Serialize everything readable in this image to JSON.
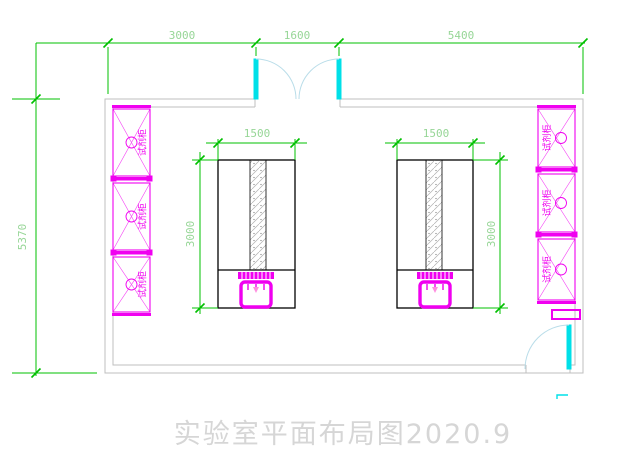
{
  "title": "实验室平面布局图2020.9",
  "colors": {
    "dimension_line": "#00c000",
    "dimension_text": "#97d697",
    "wall": "#bfbfbf",
    "cabinet": "#f000f0",
    "door": "#00e0e8",
    "door_arc": "#b9dde9",
    "bench_line": "#000000",
    "sink_accent": "#ff8fe0",
    "title_text": "#d6d6d6"
  },
  "dims": {
    "top": [
      "3000",
      "1600",
      "5400"
    ],
    "left_overall": "5370",
    "bench_left_width": "1500",
    "bench_left_depth": "3000",
    "bench_right_width": "1500",
    "bench_right_depth": "3000"
  },
  "cabinets": {
    "left": [
      {
        "label": "试剂柜"
      },
      {
        "label": "试剂柜"
      },
      {
        "label": "试剂柜"
      }
    ],
    "right": [
      {
        "label": "试剂柜"
      },
      {
        "label": "试剂柜"
      },
      {
        "label": "试剂柜"
      }
    ]
  }
}
